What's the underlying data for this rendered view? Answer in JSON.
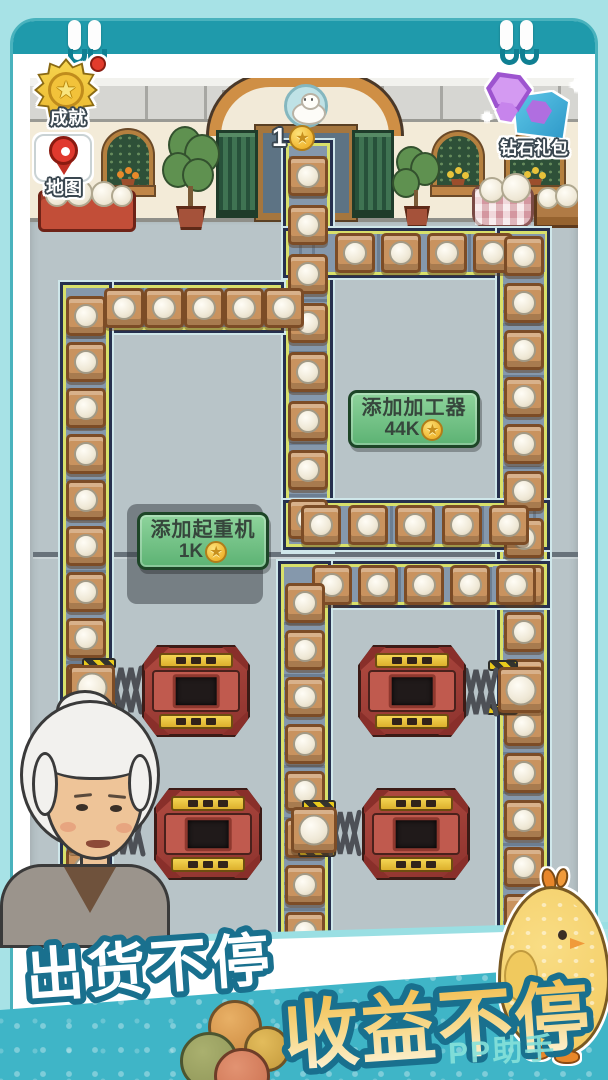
{
  "hud": {
    "achievement": {
      "label": "成就"
    },
    "map": {
      "label": "地图"
    },
    "diamond_pack": {
      "label": "钻石礼包"
    },
    "door_counter": {
      "value": "1"
    }
  },
  "buttons": {
    "add_processor": {
      "label": "添加加工器",
      "cost": "44K"
    },
    "add_crane": {
      "label": "添加起重机",
      "cost": "1K"
    }
  },
  "banner": {
    "line1": "出货不停",
    "line2": "收益不停",
    "watermark": "PP助手"
  },
  "icons": {
    "star": "★"
  },
  "colors": {
    "header_teal": "#1f9aab",
    "banner_teal": "#3fb5c7",
    "button_green": "#6fc184",
    "coin_gold": "#f0b52f",
    "machine_red": "#a8443c",
    "belt_slate": "#8598ac",
    "label_outline": "#3a4750",
    "slogan_outline": "#19708e"
  },
  "factory": {
    "belts": [
      {
        "id": "door-exit",
        "x": 283,
        "y": 140,
        "w": 50,
        "h": 412,
        "dir": "v",
        "c0": 16,
        "c1": 392,
        "step": 49
      },
      {
        "id": "top-right",
        "x": 283,
        "y": 228,
        "w": 267,
        "h": 50,
        "dir": "h",
        "c0": 52,
        "c1": 215,
        "step": 46
      },
      {
        "id": "top-left",
        "x": 60,
        "y": 282,
        "w": 224,
        "h": 51,
        "dir": "h",
        "c0": 44,
        "c1": 212,
        "step": 40
      },
      {
        "id": "left",
        "x": 60,
        "y": 282,
        "w": 52,
        "h": 658,
        "dir": "v",
        "c0": 14,
        "c1": 640,
        "step": 46
      },
      {
        "id": "right",
        "x": 497,
        "y": 228,
        "w": 53,
        "h": 712,
        "dir": "v",
        "c0": 8,
        "c1": 700,
        "step": 47
      },
      {
        "id": "mid-upper",
        "x": 283,
        "y": 500,
        "w": 267,
        "h": 50,
        "dir": "h",
        "c0": 18,
        "c1": 215,
        "step": 47
      },
      {
        "id": "mid-lower",
        "x": 278,
        "y": 561,
        "w": 272,
        "h": 47,
        "dir": "h",
        "c0": 34,
        "c1": 218,
        "step": 46
      },
      {
        "id": "center-lower",
        "x": 278,
        "y": 561,
        "w": 53,
        "h": 379,
        "dir": "v",
        "c0": 22,
        "c1": 372,
        "step": 47
      }
    ],
    "patches": [
      [
        66,
        288,
        42,
        40
      ],
      [
        272,
        288,
        16,
        40
      ],
      [
        325,
        234,
        16,
        38
      ],
      [
        503,
        234,
        42,
        38
      ],
      [
        289,
        506,
        40,
        38
      ],
      [
        493,
        505,
        18,
        40
      ],
      [
        284,
        567,
        40,
        36
      ],
      [
        493,
        566,
        18,
        36
      ]
    ],
    "machines": [
      {
        "x": 142,
        "y": 645,
        "w": 108,
        "h": 92
      },
      {
        "x": 358,
        "y": 645,
        "w": 108,
        "h": 92
      },
      {
        "x": 154,
        "y": 788,
        "w": 108,
        "h": 92
      },
      {
        "x": 362,
        "y": 788,
        "w": 108,
        "h": 92
      }
    ],
    "arms": [
      {
        "zig": [
          108,
          664,
          36,
          52
        ],
        "pads": [
          [
            82,
            658,
            34,
            11
          ],
          [
            82,
            702,
            36,
            11
          ]
        ],
        "dock": [
          92,
          688
        ]
      },
      {
        "zig": [
          462,
          666,
          38,
          52
        ],
        "pads": [
          [
            488,
            660,
            30,
            11
          ],
          [
            486,
            704,
            32,
            11
          ]
        ],
        "dock": [
          521,
          690
        ]
      },
      {
        "zig": [
          110,
          806,
          36,
          52
        ],
        "pads": [
          [
            82,
            800,
            34,
            11
          ],
          [
            82,
            844,
            36,
            11
          ]
        ],
        "dock": [
          90,
          830
        ]
      },
      {
        "zig": [
          328,
          808,
          34,
          50
        ],
        "pads": [
          [
            302,
            800,
            34,
            11
          ],
          [
            298,
            846,
            38,
            11
          ]
        ],
        "dock": [
          314,
          830
        ]
      }
    ]
  }
}
